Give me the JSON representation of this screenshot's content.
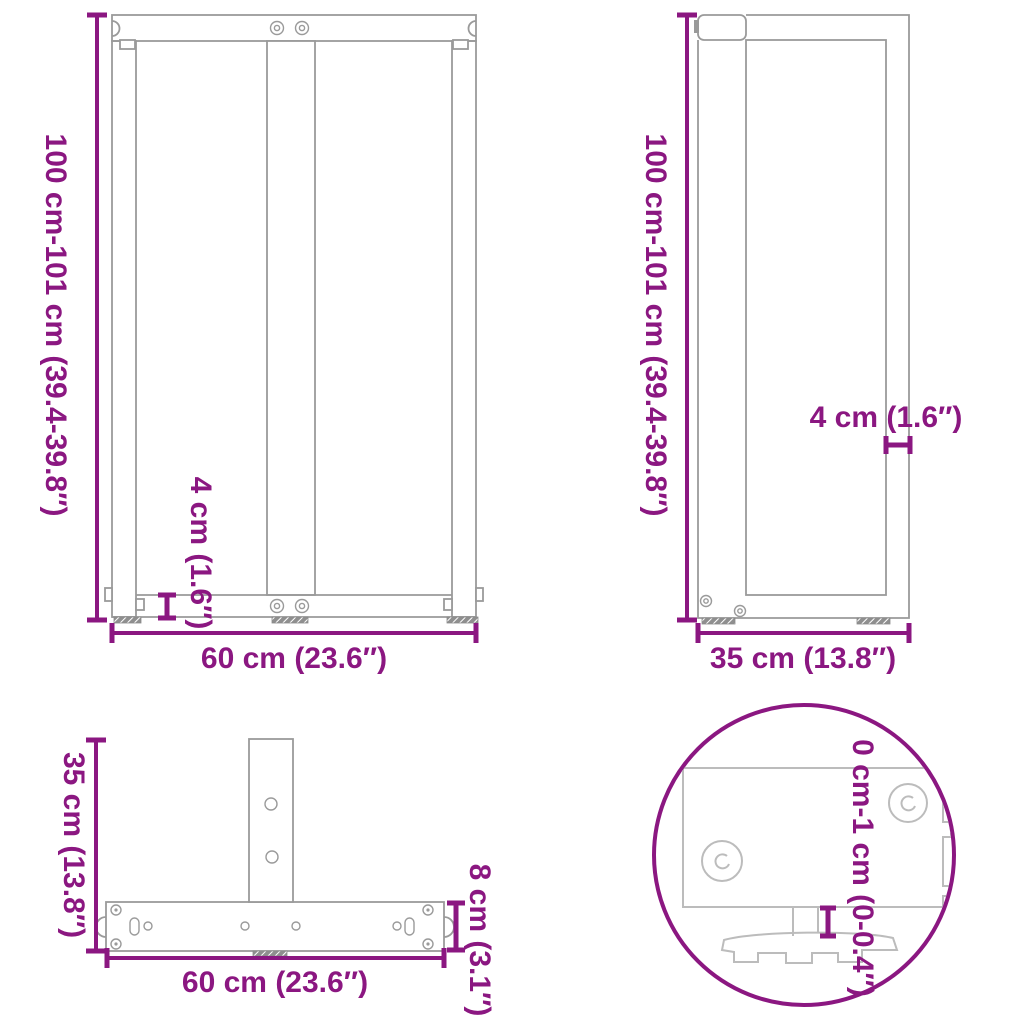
{
  "diagram_title": "T-shaped table leg dimension drawing",
  "colors": {
    "accent": "#8b1781",
    "drawing_line": "#9a9a9a",
    "detail_line": "#bcbcbc"
  },
  "front_view": {
    "height_label": "100 cm-101 cm (39.4-39.8″)",
    "width_label": "60 cm (23.6″)",
    "foot_thickness_label": "4 cm (1.6″)"
  },
  "side_view": {
    "height_label": "100 cm-101 cm (39.4-39.8″)",
    "depth_label": "35 cm (13.8″)",
    "panel_thickness_label": "4 cm (1.6″)"
  },
  "top_view": {
    "depth_label": "35 cm (13.8″)",
    "width_label": "60 cm (23.6″)",
    "bar_width_label": "8 cm (3.1″)"
  },
  "detail_view": {
    "foot_adjustment_label": "0 cm-1 cm (0-0.4″)"
  }
}
